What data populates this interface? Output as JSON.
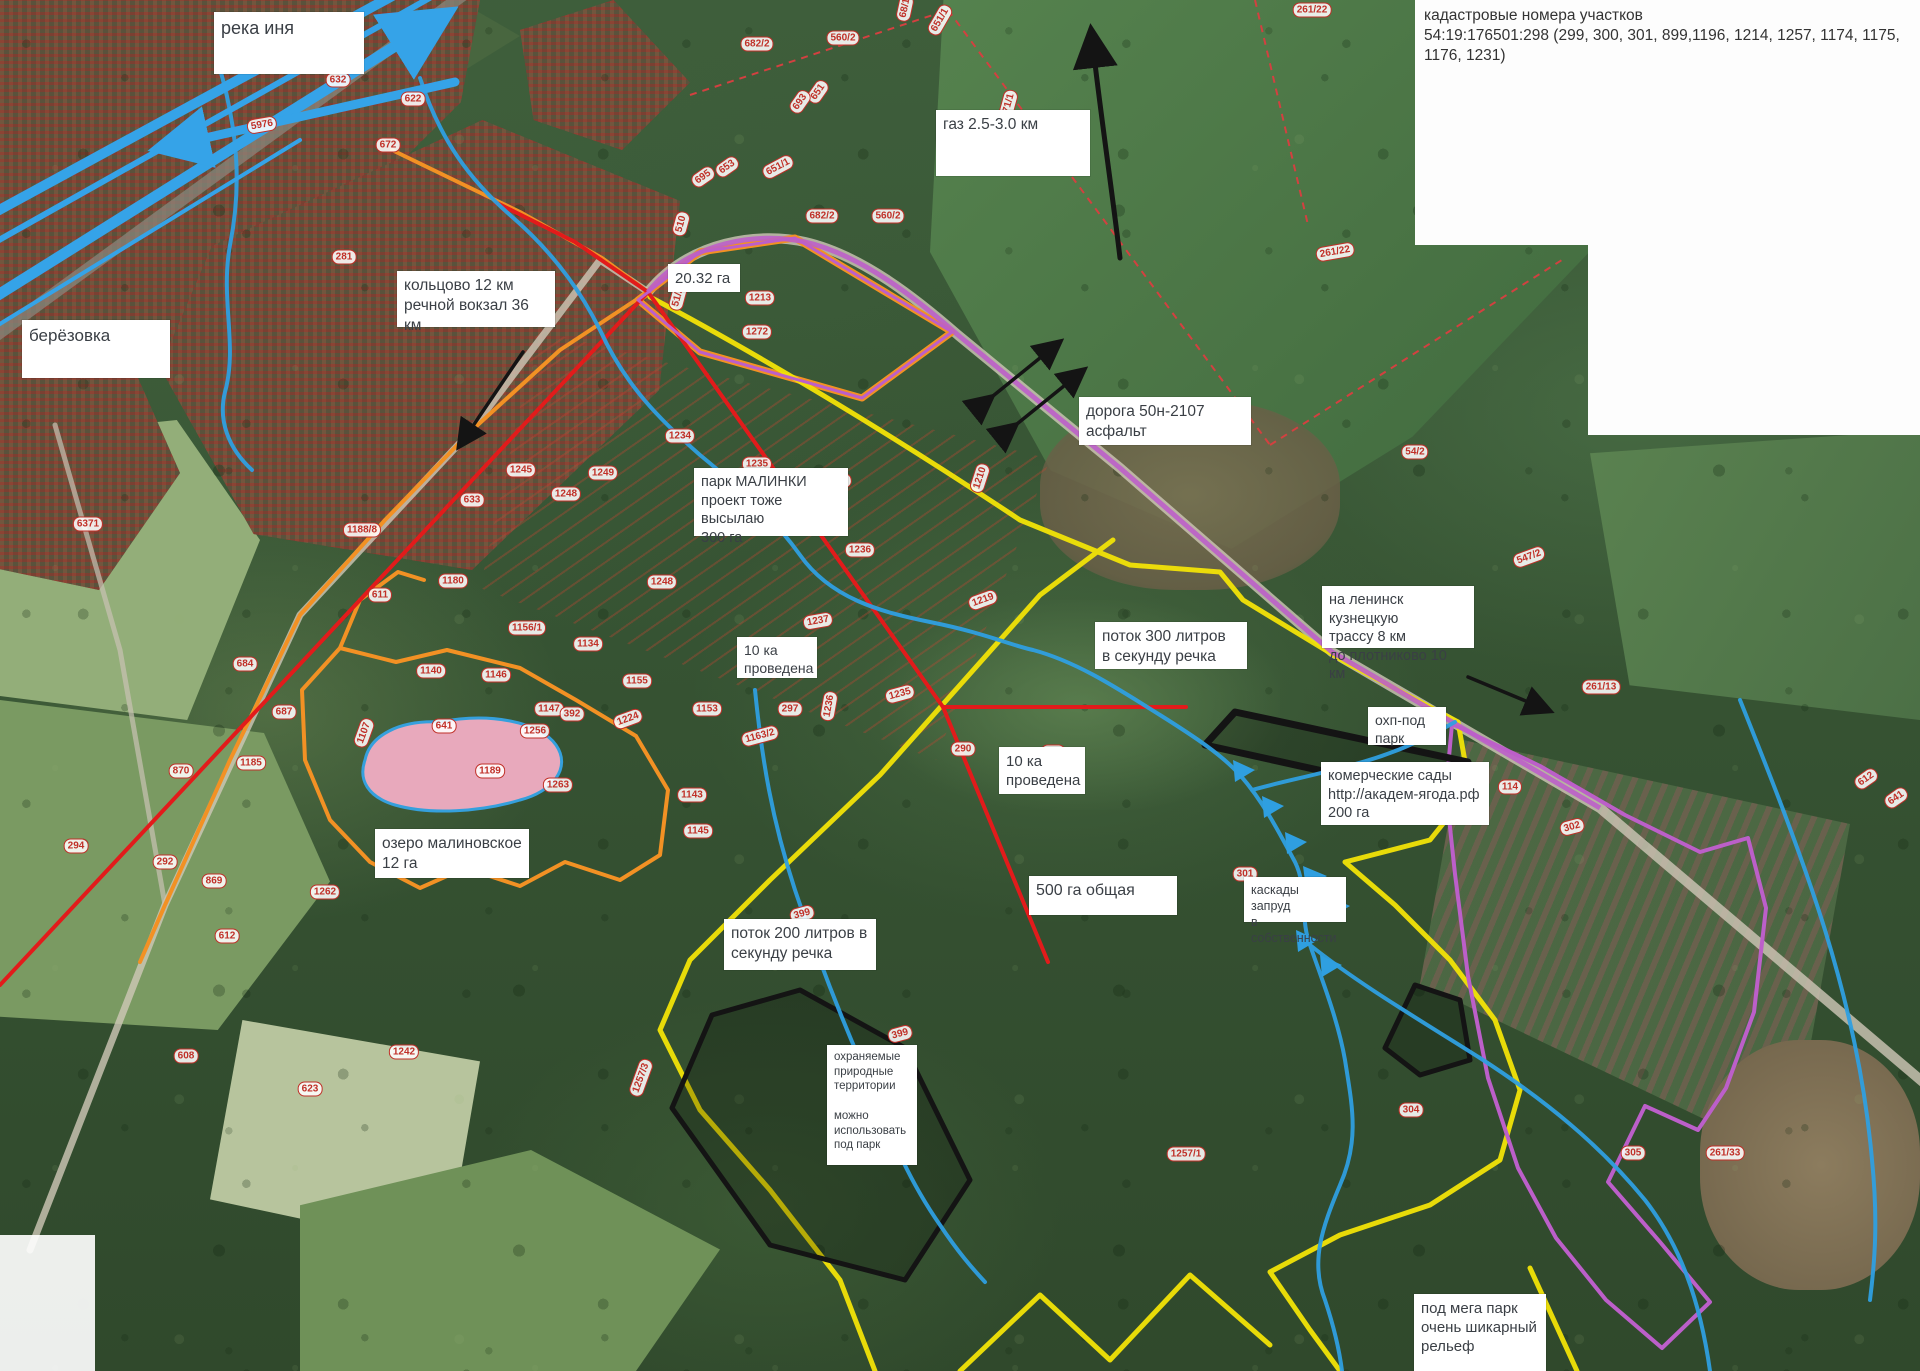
{
  "cadastral_note": {
    "text": "кадастровые номера участков\n54:19:176501:298 (299, 300, 301, 899,1196, 1214, 1257, 1174, 1175,\n1176, 1231)"
  },
  "colors": {
    "river_blue": "#35a3e8",
    "stream_blue": "#2f9fe0",
    "boundary_red": "#e21b1b",
    "boundary_yellow": "#f2e307",
    "boundary_orange": "#f29124",
    "boundary_purple": "#bc5fc9",
    "boundary_black": "#141414",
    "lake_fill": "#e8a9bc",
    "pill_red": "#c03028",
    "dashed_field_red": "#d34040"
  },
  "labels": [
    {
      "id": "reka-inya",
      "text": "река иня",
      "x": 214,
      "y": 12,
      "w": 150,
      "h": 62,
      "fs": 18
    },
    {
      "id": "berezovka",
      "text": "берёзовка",
      "x": 22,
      "y": 320,
      "w": 148,
      "h": 58,
      "fs": 17
    },
    {
      "id": "koltsovo",
      "text": "кольцово 12 км\nречной вокзал 36 км",
      "x": 397,
      "y": 271,
      "w": 158,
      "h": 56,
      "fs": 15.5
    },
    {
      "id": "gaz",
      "text": "газ 2.5-3.0 км",
      "x": 936,
      "y": 110,
      "w": 154,
      "h": 66,
      "fs": 15.5
    },
    {
      "id": "ga-2032",
      "text": "20.32 га",
      "x": 668,
      "y": 264,
      "w": 72,
      "h": 28,
      "fs": 15
    },
    {
      "id": "doroga",
      "text": "дорога 50н-2107\nасфальт",
      "x": 1079,
      "y": 397,
      "w": 172,
      "h": 48,
      "fs": 15.5
    },
    {
      "id": "park-malinki",
      "text": "парк  МАЛИНКИ\nпроект тоже высылаю\n300 га",
      "x": 694,
      "y": 468,
      "w": 154,
      "h": 68,
      "fs": 14.5
    },
    {
      "id": "provedena-1",
      "text": "10 ка\nпроведена",
      "x": 737,
      "y": 637,
      "w": 80,
      "h": 41,
      "fs": 14
    },
    {
      "id": "potok-300",
      "text": "поток 300 литров\nв секунду речка",
      "x": 1095,
      "y": 622,
      "w": 152,
      "h": 47,
      "fs": 15.5
    },
    {
      "id": "na-leninsk",
      "text": "на ленинск кузнецкую\nтрассу 8 км\nдо плотниково 10 км",
      "x": 1322,
      "y": 586,
      "w": 152,
      "h": 62,
      "fs": 14.5
    },
    {
      "id": "ohp-pod-park",
      "text": "охп-под\nпарк",
      "x": 1368,
      "y": 707,
      "w": 78,
      "h": 38,
      "fs": 14
    },
    {
      "id": "kommercheskie-sady",
      "text": "комерческие сады\nhttp://академ-ягода.рф\n200 га",
      "x": 1321,
      "y": 762,
      "w": 168,
      "h": 63,
      "fs": 14.5
    },
    {
      "id": "provedena-2",
      "text": "10 ка\nпроведена",
      "x": 999,
      "y": 747,
      "w": 86,
      "h": 47,
      "fs": 15
    },
    {
      "id": "ozero-malinovskoe",
      "text": "озеро малиновское\n12 га",
      "x": 375,
      "y": 829,
      "w": 154,
      "h": 49,
      "fs": 15.5
    },
    {
      "id": "ga-500",
      "text": "500 га общая",
      "x": 1029,
      "y": 876,
      "w": 148,
      "h": 39,
      "fs": 16
    },
    {
      "id": "kaskady",
      "text": "каскады запруд\nв собственности",
      "x": 1244,
      "y": 877,
      "w": 102,
      "h": 45,
      "fs": 12.5
    },
    {
      "id": "potok-200",
      "text": "поток 200 литров в\nсекунду речка",
      "x": 724,
      "y": 919,
      "w": 152,
      "h": 51,
      "fs": 15.5
    },
    {
      "id": "ohranyaemye",
      "text": "охраняемые\nприродные\nтерритории\n\nможно\nиспользовать\nпод парк",
      "x": 827,
      "y": 1045,
      "w": 90,
      "h": 120,
      "fs": 11.5
    },
    {
      "id": "mega-park",
      "text": "под мега парк\nочень шикарный\nрельеф",
      "x": 1414,
      "y": 1294,
      "w": 132,
      "h": 77,
      "fs": 15
    }
  ],
  "parcel_pills": [
    {
      "t": "261/22",
      "x": 1312,
      "y": 10,
      "r": 0
    },
    {
      "t": "682/2",
      "x": 757,
      "y": 44,
      "r": 0
    },
    {
      "t": "560/2",
      "x": 843,
      "y": 38,
      "r": 0
    },
    {
      "t": "651/1",
      "x": 940,
      "y": 20,
      "r": -60
    },
    {
      "t": "68/1",
      "x": 905,
      "y": 8,
      "r": -78
    },
    {
      "t": "5976",
      "x": 262,
      "y": 125,
      "r": -10
    },
    {
      "t": "632",
      "x": 338,
      "y": 80,
      "r": 0
    },
    {
      "t": "622",
      "x": 413,
      "y": 99,
      "r": 0
    },
    {
      "t": "672",
      "x": 388,
      "y": 145,
      "r": 0
    },
    {
      "t": "281",
      "x": 344,
      "y": 257,
      "r": 0
    },
    {
      "t": "695",
      "x": 703,
      "y": 177,
      "r": -35
    },
    {
      "t": "653",
      "x": 727,
      "y": 167,
      "r": -35
    },
    {
      "t": "651/1",
      "x": 778,
      "y": 167,
      "r": -28
    },
    {
      "t": "651",
      "x": 818,
      "y": 92,
      "r": -55
    },
    {
      "t": "693",
      "x": 800,
      "y": 102,
      "r": -55
    },
    {
      "t": "682/2",
      "x": 822,
      "y": 216,
      "r": 0
    },
    {
      "t": "560/2",
      "x": 888,
      "y": 216,
      "r": 0
    },
    {
      "t": "671/1",
      "x": 1008,
      "y": 106,
      "r": -75
    },
    {
      "t": "510",
      "x": 681,
      "y": 224,
      "r": -75
    },
    {
      "t": "51/2",
      "x": 678,
      "y": 297,
      "r": -75
    },
    {
      "t": "1213",
      "x": 760,
      "y": 298,
      "r": 0
    },
    {
      "t": "1272",
      "x": 757,
      "y": 332,
      "r": 0
    },
    {
      "t": "54/2",
      "x": 1415,
      "y": 452,
      "r": 0
    },
    {
      "t": "261/22",
      "x": 1335,
      "y": 252,
      "r": -10
    },
    {
      "t": "547/2",
      "x": 1529,
      "y": 557,
      "r": -20
    },
    {
      "t": "6371",
      "x": 88,
      "y": 524,
      "r": 0
    },
    {
      "t": "1188/8",
      "x": 362,
      "y": 530,
      "r": 0
    },
    {
      "t": "611",
      "x": 380,
      "y": 595,
      "r": 0
    },
    {
      "t": "633",
      "x": 472,
      "y": 500,
      "r": 0
    },
    {
      "t": "1180",
      "x": 453,
      "y": 581,
      "r": 0
    },
    {
      "t": "1245",
      "x": 521,
      "y": 470,
      "r": 0
    },
    {
      "t": "1248",
      "x": 566,
      "y": 494,
      "r": 0
    },
    {
      "t": "1249",
      "x": 603,
      "y": 473,
      "r": 0
    },
    {
      "t": "1234",
      "x": 680,
      "y": 436,
      "r": 0
    },
    {
      "t": "1235",
      "x": 757,
      "y": 464,
      "r": 0
    },
    {
      "t": "1240",
      "x": 837,
      "y": 482,
      "r": -10
    },
    {
      "t": "1210",
      "x": 980,
      "y": 478,
      "r": -72
    },
    {
      "t": "1236",
      "x": 860,
      "y": 550,
      "r": 0
    },
    {
      "t": "1248",
      "x": 662,
      "y": 582,
      "r": 0
    },
    {
      "t": "1156/1",
      "x": 527,
      "y": 628,
      "r": 0
    },
    {
      "t": "1134",
      "x": 588,
      "y": 644,
      "r": 0
    },
    {
      "t": "1155",
      "x": 637,
      "y": 681,
      "r": 0
    },
    {
      "t": "1146",
      "x": 496,
      "y": 675,
      "r": 0
    },
    {
      "t": "1147",
      "x": 549,
      "y": 709,
      "r": 0
    },
    {
      "t": "392",
      "x": 572,
      "y": 714,
      "r": 0
    },
    {
      "t": "1153",
      "x": 707,
      "y": 709,
      "r": 0
    },
    {
      "t": "297",
      "x": 790,
      "y": 709,
      "r": 0
    },
    {
      "t": "1163/2",
      "x": 760,
      "y": 736,
      "r": -15
    },
    {
      "t": "1143",
      "x": 692,
      "y": 795,
      "r": 0
    },
    {
      "t": "1145",
      "x": 698,
      "y": 831,
      "r": 0
    },
    {
      "t": "1140",
      "x": 431,
      "y": 671,
      "r": 0
    },
    {
      "t": "641",
      "x": 444,
      "y": 726,
      "r": 0
    },
    {
      "t": "1107",
      "x": 364,
      "y": 733,
      "r": -70
    },
    {
      "t": "1189",
      "x": 490,
      "y": 771,
      "r": 0
    },
    {
      "t": "1263",
      "x": 558,
      "y": 785,
      "r": 0
    },
    {
      "t": "1256",
      "x": 535,
      "y": 731,
      "r": 0
    },
    {
      "t": "684",
      "x": 245,
      "y": 664,
      "r": 0
    },
    {
      "t": "687",
      "x": 284,
      "y": 712,
      "r": 0
    },
    {
      "t": "870",
      "x": 181,
      "y": 771,
      "r": 0
    },
    {
      "t": "869",
      "x": 214,
      "y": 881,
      "r": 0
    },
    {
      "t": "1185",
      "x": 251,
      "y": 763,
      "r": 0
    },
    {
      "t": "1262",
      "x": 325,
      "y": 892,
      "r": 0
    },
    {
      "t": "294",
      "x": 76,
      "y": 846,
      "r": 0
    },
    {
      "t": "292",
      "x": 165,
      "y": 862,
      "r": 0
    },
    {
      "t": "612",
      "x": 227,
      "y": 936,
      "r": 0
    },
    {
      "t": "608",
      "x": 186,
      "y": 1056,
      "r": 0
    },
    {
      "t": "623",
      "x": 310,
      "y": 1089,
      "r": 0
    },
    {
      "t": "1242",
      "x": 404,
      "y": 1052,
      "r": 0
    },
    {
      "t": "1224",
      "x": 628,
      "y": 719,
      "r": -20
    },
    {
      "t": "1237",
      "x": 818,
      "y": 621,
      "r": -10
    },
    {
      "t": "1219",
      "x": 983,
      "y": 600,
      "r": -20
    },
    {
      "t": "1235",
      "x": 900,
      "y": 694,
      "r": -15
    },
    {
      "t": "1236",
      "x": 829,
      "y": 706,
      "r": -80
    },
    {
      "t": "290",
      "x": 963,
      "y": 749,
      "r": 0
    },
    {
      "t": "299",
      "x": 1053,
      "y": 752,
      "r": 0
    },
    {
      "t": "399",
      "x": 802,
      "y": 914,
      "r": -15
    },
    {
      "t": "399",
      "x": 900,
      "y": 1034,
      "r": -15
    },
    {
      "t": "1257/3",
      "x": 641,
      "y": 1078,
      "r": -70
    },
    {
      "t": "1257/1",
      "x": 1186,
      "y": 1154,
      "r": 0
    },
    {
      "t": "301",
      "x": 1245,
      "y": 874,
      "r": 0
    },
    {
      "t": "114",
      "x": 1510,
      "y": 787,
      "r": 0
    },
    {
      "t": "261/13",
      "x": 1601,
      "y": 687,
      "r": 0
    },
    {
      "t": "302",
      "x": 1572,
      "y": 827,
      "r": -15
    },
    {
      "t": "304",
      "x": 1411,
      "y": 1110,
      "r": 0
    },
    {
      "t": "305",
      "x": 1633,
      "y": 1153,
      "r": 0
    },
    {
      "t": "261/33",
      "x": 1725,
      "y": 1153,
      "r": 0
    },
    {
      "t": "612",
      "x": 1866,
      "y": 779,
      "r": -35
    },
    {
      "t": "641",
      "x": 1896,
      "y": 798,
      "r": -35
    }
  ]
}
